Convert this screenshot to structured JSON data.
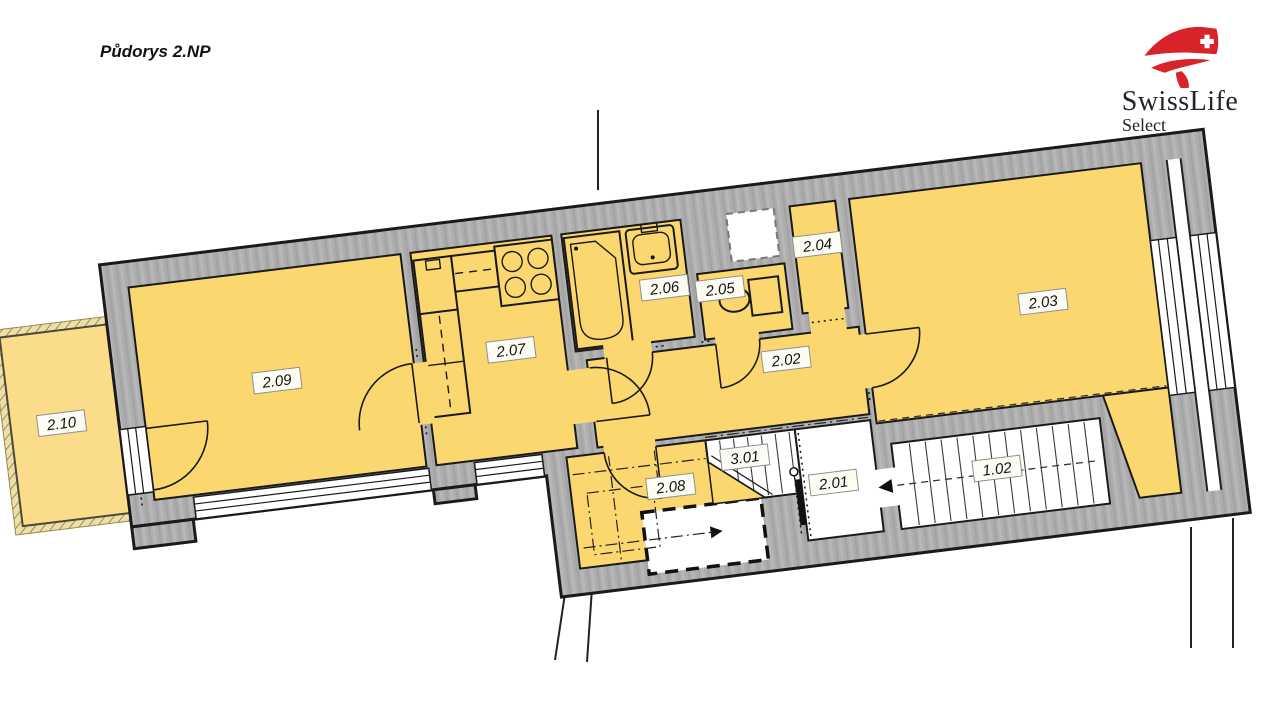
{
  "title": "Půdorys 2.NP",
  "logo": {
    "brand": "SwissLife",
    "sub": "Select"
  },
  "colors": {
    "room_fill": "#fbd76f",
    "balcony_fill": "#fbdc8a",
    "wall_fill": "#adadad",
    "outline": "#1a1a1a",
    "logo_red": "#d8232a",
    "logo_text": "#20242c"
  },
  "floor_plan": {
    "rotation_deg": -7,
    "rooms": [
      {
        "id": "2.09",
        "x": 282,
        "y": 337
      },
      {
        "id": "2.10",
        "x": 63,
        "y": 353
      },
      {
        "id": "2.07",
        "x": 518,
        "y": 335
      },
      {
        "id": "2.06",
        "x": 678,
        "y": 292
      },
      {
        "id": "2.05",
        "x": 733,
        "y": 300
      },
      {
        "id": "2.04",
        "x": 835,
        "y": 268
      },
      {
        "id": "2.02",
        "x": 790,
        "y": 378
      },
      {
        "id": "2.03",
        "x": 1052,
        "y": 352
      },
      {
        "id": "2.08",
        "x": 660,
        "y": 490
      },
      {
        "id": "3.01",
        "x": 737,
        "y": 470
      },
      {
        "id": "2.01",
        "x": 822,
        "y": 506
      },
      {
        "id": "1.02",
        "x": 986,
        "y": 512
      }
    ]
  }
}
